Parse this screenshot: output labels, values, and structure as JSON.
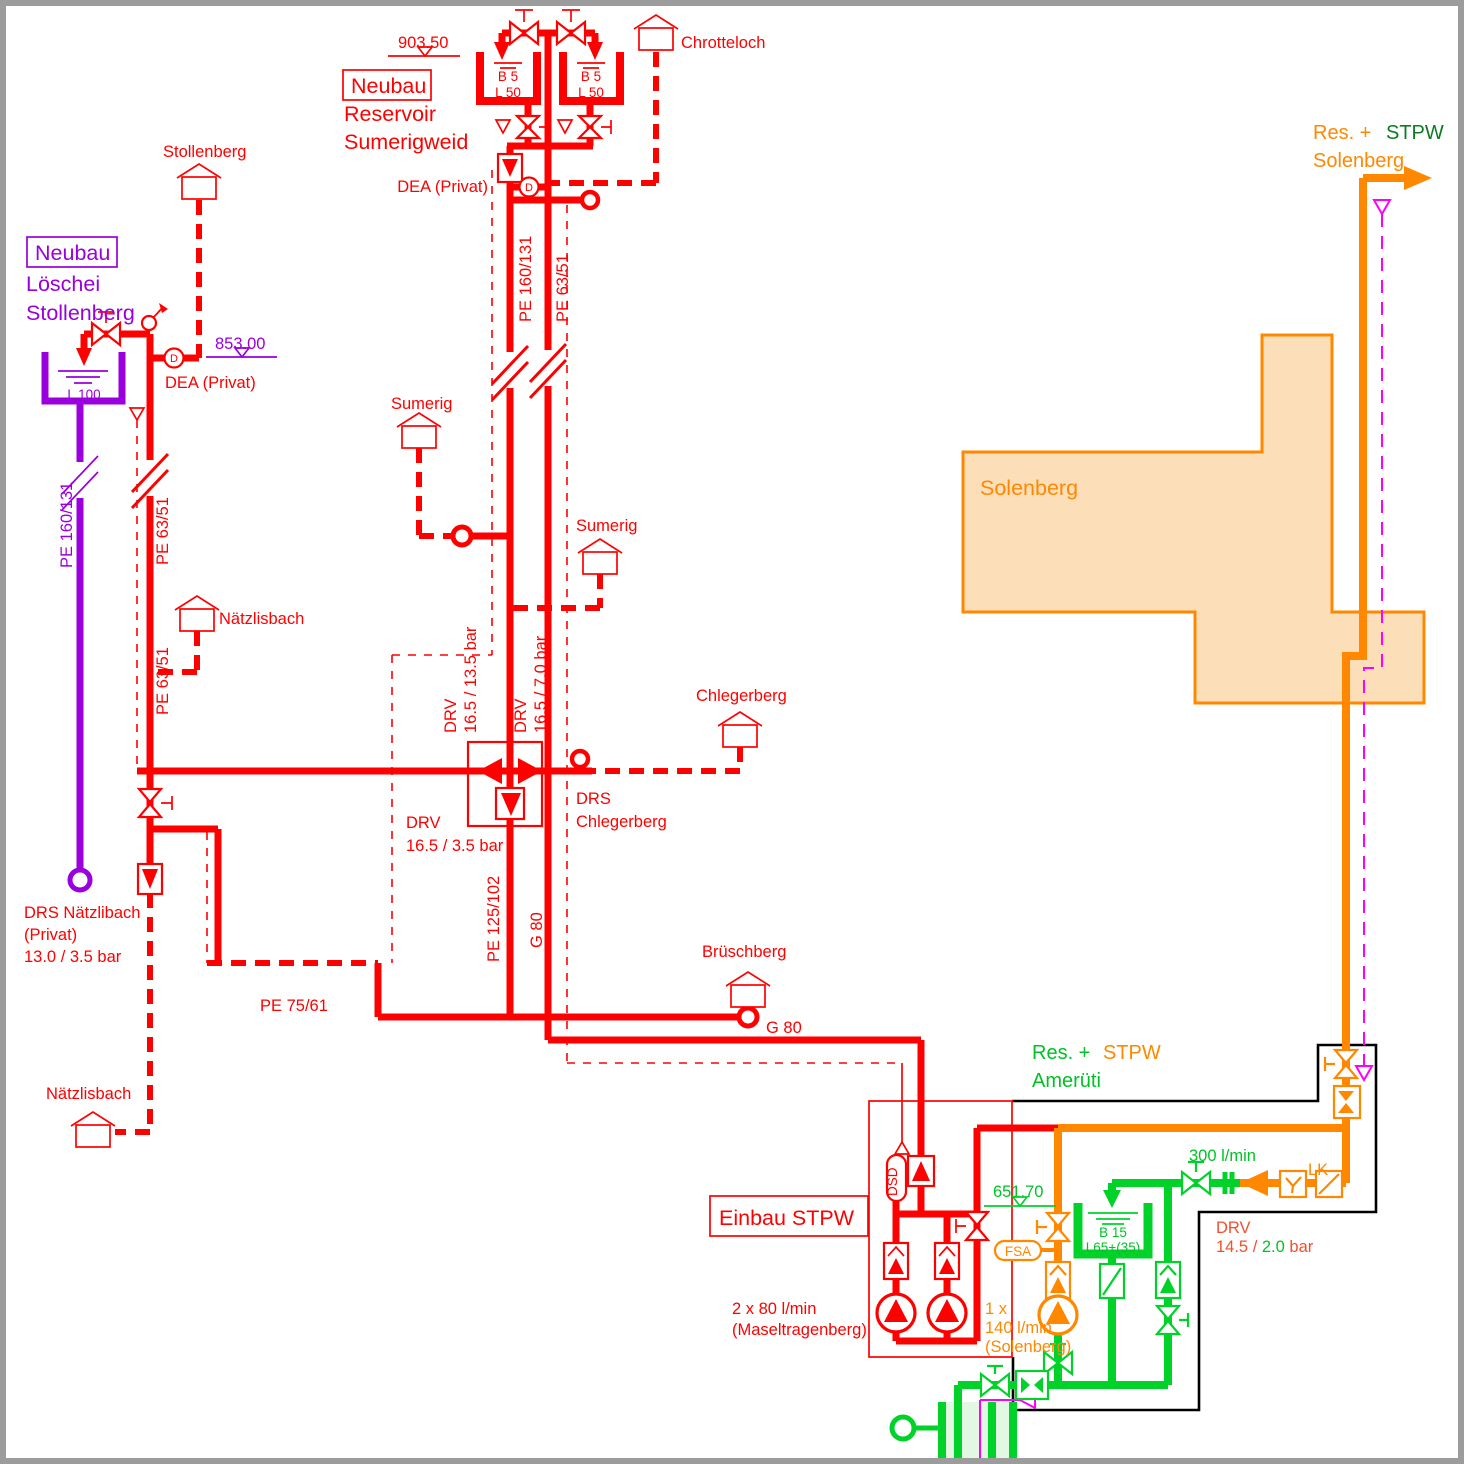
{
  "colors": {
    "red": "#ff0000",
    "purple": "#9900dd",
    "orange": "#ff8800",
    "orange_fill": "#fcdfb8",
    "green": "#00d22a",
    "dark_green": "#0a7d22",
    "drv_orange_red": "#f0512c",
    "magenta": "#ff00ff",
    "outline_black": "#000000",
    "frame_gray": "#9c9c9c"
  },
  "labels": {
    "res_sumerigweid": {
      "elevation": "903.50",
      "box": "Neubau",
      "line2": "Reservoir",
      "line3": "Sumerigweid",
      "tank1a": "B 5",
      "tank1b": "L 50",
      "tank2a": "B 5",
      "tank2b": "L 50",
      "dea": "DEA (Privat)",
      "pe_main": "PE 160/131",
      "pe_branch": "PE 63/51",
      "chrotteloch": "Chrotteloch"
    },
    "loeschei": {
      "box": "Neubau",
      "line2": "Löschei",
      "line3": "Stollenberg",
      "elevation": "853.00",
      "tank": "L 100",
      "dea": "DEA (Privat)",
      "pe": "PE 160/131",
      "stollenberg": "Stollenberg"
    },
    "left": {
      "pe1": "PE 63/51",
      "pe2": "PE 63/51",
      "haus_mid": "Nätzlisbach",
      "drs1": "DRS Nätzlibach",
      "drs2": "(Privat)",
      "drs3": "13.0 / 3.5 bar",
      "haus_unten": "Nätzlisbach",
      "pe75": "PE 75/61"
    },
    "mitte": {
      "sumerig1": "Sumerig",
      "sumerig2": "Sumerig",
      "drv_l1": "DRV",
      "drv_l2": "16.5 / 13.5 bar",
      "drv_r1": "DRV",
      "drv_r2": "16.5 / 7.0 bar",
      "drv_u1": "DRV",
      "drv_u2": "16.5 / 3.5 bar",
      "chlegerberg": "Chlegerberg",
      "drs1": "DRS",
      "drs2": "Chlegerberg",
      "pe125": "PE 125/102",
      "g80v": "G 80",
      "bruschberg": "Brüschberg",
      "g80h": "G 80"
    },
    "solenberg": {
      "res": "Res. +",
      "stpw": "STPW",
      "ort": "Solenberg",
      "gebiet": "Solenberg"
    },
    "amerueti": {
      "res": "Res. +",
      "stpw": "STPW",
      "ort": "Amerüti"
    },
    "station": {
      "titel": "Einbau STPW",
      "rp1": "2 x 80 l/min",
      "rp2": "(Maseltragenberg)",
      "op1": "1 x",
      "op2": "140 l/min",
      "op3": "(Solenberg)",
      "dsd": "DSD",
      "fsa": "FSA",
      "elevation": "651.70",
      "tank1": "B 15",
      "tank2": "L65+(35)",
      "flow": "300 l/min",
      "lk": "LK",
      "drv1": "DRV",
      "drv2a": "14.5 / ",
      "drv2b": "2.0",
      "drv2c": " bar"
    }
  }
}
